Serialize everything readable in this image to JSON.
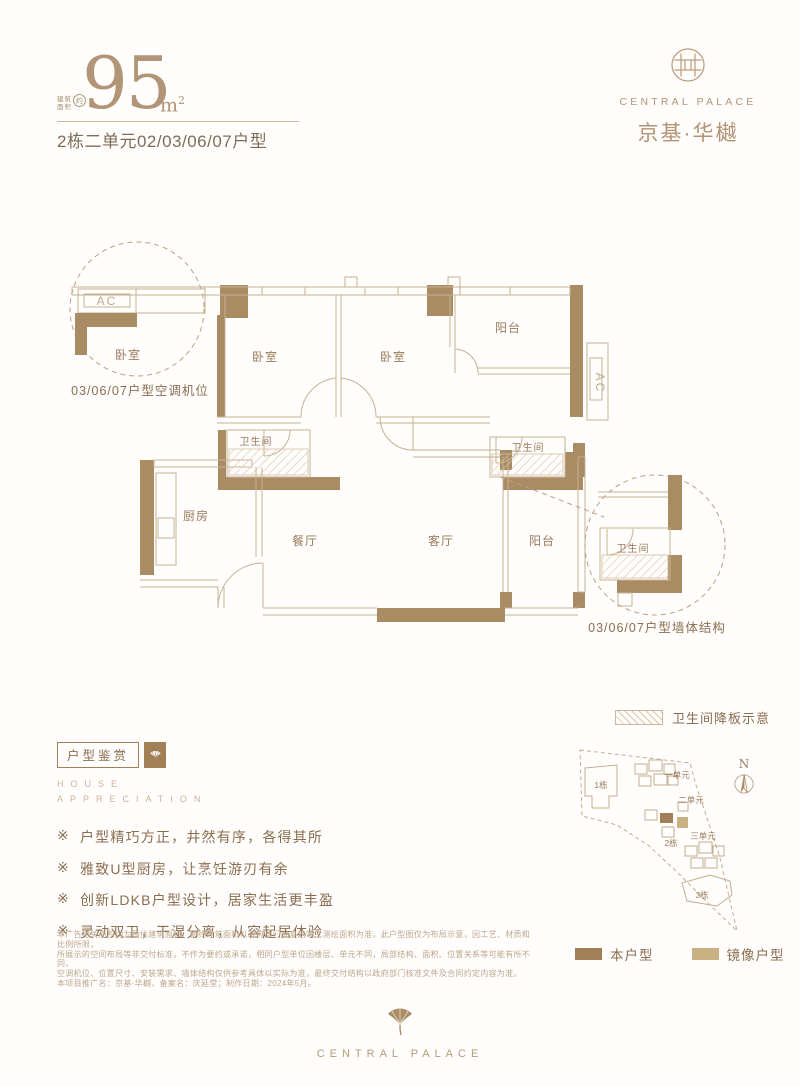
{
  "header": {
    "area_prefix_line1": "建筑",
    "area_prefix_line2": "面积",
    "area_approx": "约",
    "area_number": "95",
    "area_unit": "m",
    "area_unit_sup": "2",
    "subtitle": "2栋二单元02/03/06/07户型"
  },
  "brand": {
    "name_en": "CENTRAL PALACE",
    "name_cn": "京基·华樾",
    "footer_en": "CENTRAL PALACE"
  },
  "plan": {
    "rooms": {
      "bedroom_left": "卧室",
      "bedroom_mid": "卧室",
      "balcony_top": "阳台",
      "bath_left": "卫生间",
      "bath_right": "卫生间",
      "kitchen": "厨房",
      "dining": "餐厅",
      "living": "客厅",
      "balcony_bottom": "阳台"
    },
    "ac_label": "AC",
    "callout_left": {
      "ac": "AC",
      "room": "卧室",
      "caption": "03/06/07户型空调机位"
    },
    "callout_right": {
      "room": "卫生间",
      "caption": "03/06/07户型墙体结构"
    }
  },
  "legend": {
    "sunken_slab": "卫生间降板示意",
    "this_unit": "本户型",
    "mirror_unit": "镜像户型",
    "this_unit_color": "#a28057",
    "mirror_unit_color": "#c9b183"
  },
  "site_map": {
    "north": "N",
    "buildings": {
      "b1": "1栋",
      "b2": "2栋",
      "b3": "3栋"
    },
    "units": {
      "u1": "一单元",
      "u2": "二单元",
      "u3": "三单元"
    }
  },
  "appreciation": {
    "title": "户型鉴赏",
    "en_line1": "HOUSE",
    "en_line2": "APPRECIATION",
    "marker": "※",
    "bullets": [
      "户型精巧方正，井然有序，各得其所",
      "雅致U型厨房，让烹饪游刃有余",
      "创新LDKB户型设计，居家生活更丰盈",
      "灵动双卫，干湿分离，从容起居体验"
    ]
  },
  "disclaimer": {
    "line1": "本广告相关面积均为预估建筑面积，最终建筑面积以政府部门批复的竣工测绘面积为准，此户型图仅为布局示意，因工艺、材质和比例所限，",
    "line2": "所展示的空间布局等非交付标准，不作为要约或承诺，相同户型单位因楼层、单元不同，局部结构、面积、位置关系等可能有所不同，",
    "line3": "空调机位、位置尺寸、安装需求、墙体结构仅供参考具体以实际为准，最终交付结构以政府部门核准文件及合同约定内容为准。",
    "line4": "本项目推广名：京基·华樾，备案名：庆延堂；制作日期：2024年5月。"
  },
  "colors": {
    "wall": "#a98b64",
    "accent": "#b29477",
    "text": "#8b6d4f"
  }
}
